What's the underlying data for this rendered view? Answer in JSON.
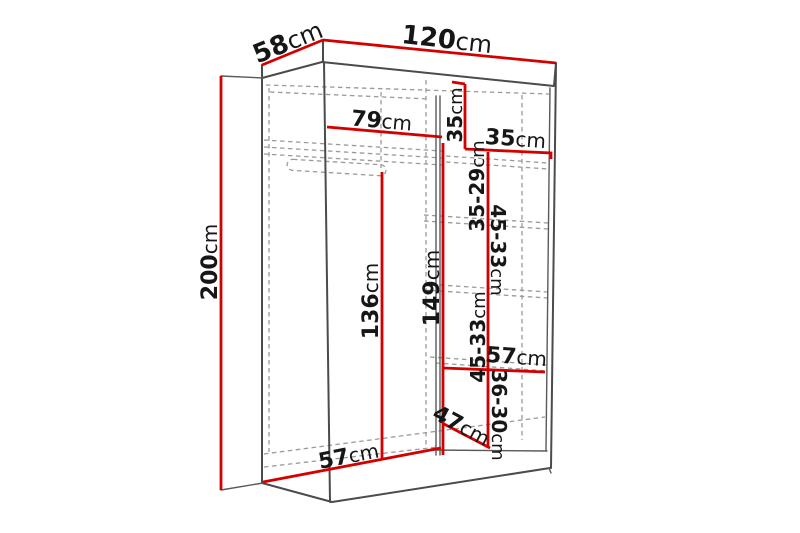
{
  "diagram": {
    "subject": "wardrobe-dimension-drawing",
    "unit": "cm",
    "colors": {
      "dimension_line": "#d40000",
      "outline": "#4b4b4b",
      "hidden_line": "#9a9a9a",
      "label_text": "#161616",
      "background": "#ffffff"
    },
    "dims": {
      "depth": {
        "num": "58",
        "unit": "cm"
      },
      "width": {
        "num": "120",
        "unit": "cm"
      },
      "height": {
        "num": "200",
        "unit": "cm"
      },
      "top_left_width": {
        "num": "79",
        "unit": "cm"
      },
      "cubby_height": {
        "num": "35",
        "unit": "cm"
      },
      "cubby_width": {
        "num": "35",
        "unit": "cm"
      },
      "shelf_gap_1": {
        "num": "35-29",
        "unit": "cm"
      },
      "shelf_gap_2": {
        "num": "45-33",
        "unit": "cm"
      },
      "shelf_gap_3": {
        "num": "45-33",
        "unit": "cm"
      },
      "shelf_gap_4": {
        "num": "36-30",
        "unit": "cm"
      },
      "left_height": {
        "num": "136",
        "unit": "cm"
      },
      "right_height": {
        "num": "149",
        "unit": "cm"
      },
      "shelf_width": {
        "num": "57",
        "unit": "cm"
      },
      "bottom_depth": {
        "num": "47",
        "unit": "cm"
      },
      "floor_depth": {
        "num": "57",
        "unit": "cm"
      }
    }
  }
}
